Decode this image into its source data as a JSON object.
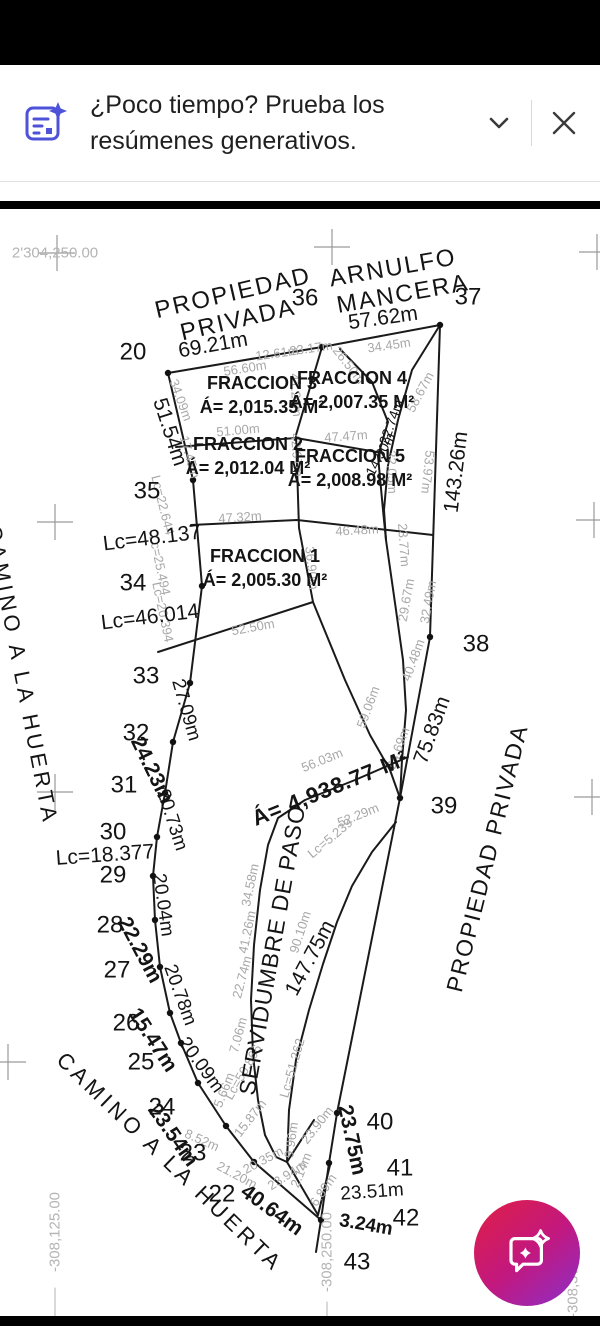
{
  "banner": {
    "title_line1": "¿Poco tiempo? Prueba los",
    "title_line2": "resúmenes generativos.",
    "accent_color": "#4e52d8"
  },
  "fab": {
    "icon": "ai-assistant-chat-icon",
    "gradient": [
      "#e01f45",
      "#c2187f",
      "#8b2fc9"
    ]
  },
  "drawing": {
    "colors": {
      "line": "#1a1a1a",
      "secondary_text": "#a8a8a8",
      "grid": "#9a9a9a"
    },
    "crosses": [
      [
        57,
        43
      ],
      [
        332,
        37
      ],
      [
        597,
        42
      ],
      [
        55,
        312
      ],
      [
        594,
        310
      ],
      [
        55,
        582
      ],
      [
        592,
        587
      ],
      [
        8,
        852
      ]
    ],
    "grid": [
      [
        "2'304,250.00",
        55,
        43,
        0
      ],
      [
        "-308,125.00",
        55,
        1022,
        -90
      ],
      [
        "-308,250.00",
        327,
        1042,
        -90
      ],
      [
        "-308,375.00",
        573,
        1068,
        -90
      ]
    ],
    "points": [
      [
        "20",
        133,
        142
      ],
      [
        "36",
        305,
        88
      ],
      [
        "37",
        468,
        87
      ],
      [
        "35",
        147,
        281
      ],
      [
        "34",
        133,
        373
      ],
      [
        "33",
        146,
        466
      ],
      [
        "32",
        136,
        523
      ],
      [
        "31",
        124,
        575
      ],
      [
        "30",
        113,
        622
      ],
      [
        "29",
        113,
        665
      ],
      [
        "28",
        110,
        715
      ],
      [
        "27",
        117,
        760
      ],
      [
        "26",
        126,
        813
      ],
      [
        "25",
        141,
        852
      ],
      [
        "24",
        162,
        897
      ],
      [
        "23",
        193,
        943
      ],
      [
        "22",
        222,
        984
      ],
      [
        "38",
        476,
        434
      ],
      [
        "39",
        444,
        596
      ],
      [
        "40",
        380,
        912
      ],
      [
        "41",
        400,
        958
      ],
      [
        "42",
        406,
        1008
      ],
      [
        "43",
        357,
        1052
      ]
    ],
    "titles": [
      [
        "PROPIEDAD",
        233,
        83,
        -13,
        24,
        0,
        2
      ],
      [
        "PRIVADA",
        238,
        110,
        -13,
        24,
        0,
        2
      ],
      [
        "ARNULFO",
        393,
        58,
        -10,
        24,
        0,
        2
      ],
      [
        "MANCERA",
        403,
        84,
        -10,
        24,
        0,
        2
      ],
      [
        "CAMINO A LA HUERTA",
        22,
        465,
        79,
        22,
        0,
        4
      ],
      [
        "CAMINO A LA HUERTA",
        170,
        952,
        44,
        22,
        0,
        4
      ],
      [
        "SERVIDUMBRE DE PASO",
        272,
        740,
        -80,
        23,
        0,
        1
      ],
      [
        "PROPIEDAD PRIVADA",
        487,
        648,
        -76,
        23,
        0,
        2
      ],
      [
        "Á= 4,938.77 M²",
        330,
        578,
        -22,
        22,
        1,
        1
      ]
    ],
    "fractions": [
      [
        "FRACCION 3",
        262,
        173,
        0,
        18,
        1
      ],
      [
        "Á= 2,015.35 M²",
        262,
        197,
        0,
        18,
        1
      ],
      [
        "FRACCION 4",
        352,
        168,
        0,
        18,
        1
      ],
      [
        "Á= 2,007.35 M²",
        352,
        192,
        0,
        18,
        1
      ],
      [
        "FRACCION 2",
        248,
        234,
        0,
        18,
        1
      ],
      [
        "Á= 2,012.04 M²",
        248,
        258,
        0,
        18,
        1
      ],
      [
        "FRACCION 5",
        350,
        246,
        0,
        18,
        1
      ],
      [
        "Á= 2,008.98 M²",
        350,
        270,
        0,
        18,
        1
      ],
      [
        "FRACCION 1",
        265,
        346,
        0,
        18,
        1
      ],
      [
        "Á= 2,005.30 M²",
        265,
        370,
        0,
        18,
        1
      ]
    ],
    "primary": [
      [
        "57.62m",
        383,
        108,
        -8,
        21
      ],
      [
        "69.21m",
        213,
        135,
        -10,
        21
      ],
      [
        "51.54m",
        170,
        222,
        72,
        21
      ],
      [
        "Lc=48.137",
        152,
        328,
        -7,
        21
      ],
      [
        "Lc=46.014",
        150,
        407,
        -7,
        21
      ],
      [
        "Lc=18.377",
        105,
        645,
        -4,
        21
      ],
      [
        "27.09m",
        186,
        500,
        74,
        19
      ],
      [
        "24.23m",
        152,
        560,
        64,
        21,
        1
      ],
      [
        "20.73m",
        172,
        610,
        72,
        19
      ],
      [
        "20.04m",
        163,
        695,
        82,
        19
      ],
      [
        "22.29m",
        140,
        740,
        62,
        21,
        1
      ],
      [
        "20.78m",
        180,
        785,
        70,
        19
      ],
      [
        "15.47m",
        153,
        830,
        57,
        21,
        1
      ],
      [
        "20.09m",
        201,
        855,
        54,
        19
      ],
      [
        "23.54m",
        173,
        925,
        55,
        21,
        1
      ],
      [
        "40.64m",
        272,
        1000,
        36,
        21,
        1
      ],
      [
        "23.75m",
        352,
        930,
        78,
        21,
        1
      ],
      [
        "23.51m",
        372,
        982,
        -4,
        19
      ],
      [
        "3.24m",
        366,
        1015,
        10,
        19,
        1
      ],
      [
        "143.26m",
        456,
        262,
        -83,
        21
      ],
      [
        "75.83m",
        432,
        520,
        -70,
        21
      ],
      [
        "147.75m",
        310,
        748,
        -62,
        21
      ],
      [
        "22.74m",
        391,
        212,
        -70,
        14
      ],
      [
        "14.50m",
        380,
        244,
        -62,
        14
      ]
    ],
    "secondary": [
      [
        "56.60m",
        245,
        158,
        -9
      ],
      [
        "12.61m",
        277,
        143,
        -8
      ],
      [
        "23.17m",
        311,
        138,
        -8
      ],
      [
        "26.50m",
        349,
        155,
        52
      ],
      [
        "34.45m",
        389,
        135,
        -8
      ],
      [
        "41.21m",
        296,
        185,
        86
      ],
      [
        "58.67m",
        420,
        182,
        -62
      ],
      [
        "51.00m",
        238,
        220,
        -5
      ],
      [
        "47.47m",
        346,
        226,
        -4
      ],
      [
        "34.09m",
        181,
        190,
        70
      ],
      [
        "17.45m",
        190,
        247,
        74
      ],
      [
        "32.05m",
        392,
        262,
        88
      ],
      [
        "53.97m",
        428,
        262,
        96
      ],
      [
        "42.97m",
        297,
        245,
        86
      ],
      [
        "Lc=22.644",
        163,
        295,
        76
      ],
      [
        "47.32m",
        240,
        307,
        -4
      ],
      [
        "46.48m",
        357,
        320,
        -3
      ],
      [
        "23.77m",
        404,
        335,
        86
      ],
      [
        "Lc=25.494",
        160,
        355,
        78
      ],
      [
        "36.90m",
        312,
        358,
        84
      ],
      [
        "Lc=20.394",
        163,
        402,
        78
      ],
      [
        "29.67m",
        406,
        390,
        -80
      ],
      [
        "32.49m",
        428,
        392,
        -80
      ],
      [
        "52.50m",
        253,
        417,
        -10
      ],
      [
        "40.48m",
        413,
        450,
        -70
      ],
      [
        "59.06m",
        368,
        497,
        -70
      ],
      [
        "24.69m",
        398,
        538,
        -70
      ],
      [
        "56.03m",
        322,
        550,
        -22
      ],
      [
        "52.29m",
        358,
        605,
        -22
      ],
      [
        "Lc=5.239",
        330,
        628,
        -40
      ],
      [
        "34.58m",
        250,
        675,
        -78
      ],
      [
        "90.10m",
        300,
        722,
        -72
      ],
      [
        "41.26m",
        247,
        722,
        -78
      ],
      [
        "22.74m",
        242,
        767,
        -75
      ],
      [
        "7.06m",
        238,
        825,
        -75
      ],
      [
        "5.66m",
        224,
        880,
        -68
      ],
      [
        "Lc=50.866",
        243,
        862,
        -60
      ],
      [
        "15.87m",
        250,
        908,
        -52
      ],
      [
        "Lc=51.262",
        292,
        858,
        -74
      ],
      [
        "23.90m",
        317,
        915,
        -52
      ],
      [
        "9.96m",
        291,
        930,
        -82
      ],
      [
        "20.35m",
        263,
        950,
        -28
      ],
      [
        "23.94m",
        287,
        965,
        -33
      ],
      [
        "2.14m",
        301,
        960,
        -68
      ],
      [
        "6.89m",
        323,
        980,
        -55
      ],
      [
        "8.52m",
        202,
        930,
        24
      ],
      [
        "21.20m",
        237,
        965,
        28
      ]
    ],
    "lines": [
      {
        "n": "boundary-west",
        "p": [
          [
            168,
            163
          ],
          [
            193,
            270
          ],
          [
            202,
            376
          ],
          [
            190,
            473
          ],
          [
            173,
            532
          ],
          [
            165,
            583
          ],
          [
            157,
            627
          ],
          [
            153,
            666
          ],
          [
            155,
            710
          ],
          [
            160,
            757
          ],
          [
            170,
            803
          ],
          [
            181,
            833
          ],
          [
            198,
            873
          ],
          [
            226,
            916
          ],
          [
            254,
            952
          ]
        ]
      },
      {
        "n": "boundary-top",
        "p": [
          [
            168,
            163
          ],
          [
            322,
            137
          ],
          [
            440,
            115
          ]
        ]
      },
      {
        "n": "boundary-east",
        "p": [
          [
            440,
            115
          ],
          [
            430,
            427
          ],
          [
            400,
            588
          ],
          [
            337,
            903
          ],
          [
            329,
            953
          ],
          [
            321,
            1010
          ],
          [
            316,
            1042
          ]
        ]
      },
      {
        "n": "boundary-bottom",
        "p": [
          [
            254,
            952
          ],
          [
            321,
            1010
          ]
        ]
      },
      {
        "n": "divider-center",
        "p": [
          [
            322,
            137
          ],
          [
            296,
            225
          ],
          [
            299,
            318
          ],
          [
            313,
            392
          ]
        ]
      },
      {
        "n": "divider-f3-f2",
        "p": [
          [
            176,
            237
          ],
          [
            296,
            228
          ],
          [
            383,
            243
          ]
        ]
      },
      {
        "n": "divider-f2-f1",
        "p": [
          [
            191,
            315
          ],
          [
            297,
            310
          ],
          [
            433,
            325
          ]
        ]
      },
      {
        "n": "f1-south",
        "p": [
          [
            158,
            442
          ],
          [
            313,
            392
          ]
        ]
      },
      {
        "n": "east-zigzag",
        "p": [
          [
            340,
            139
          ],
          [
            372,
            172
          ],
          [
            388,
            212
          ],
          [
            378,
            246
          ],
          [
            383,
            300
          ],
          [
            386,
            330
          ],
          [
            396,
            400
          ],
          [
            403,
            450
          ],
          [
            406,
            500
          ],
          [
            402,
            550
          ],
          [
            400,
            588
          ]
        ]
      },
      {
        "n": "east-sliver",
        "p": [
          [
            440,
            115
          ],
          [
            412,
            160
          ],
          [
            398,
            210
          ],
          [
            388,
            255
          ],
          [
            384,
            300
          ],
          [
            386,
            330
          ]
        ]
      },
      {
        "n": "south-f1-line",
        "p": [
          [
            313,
            392
          ],
          [
            345,
            470
          ],
          [
            370,
            525
          ],
          [
            390,
            560
          ],
          [
            400,
            588
          ]
        ]
      },
      {
        "n": "easement-west",
        "p": [
          [
            408,
            547
          ],
          [
            355,
            570
          ],
          [
            305,
            590
          ],
          [
            278,
            608
          ],
          [
            268,
            635
          ],
          [
            260,
            680
          ],
          [
            254,
            735
          ],
          [
            251,
            790
          ],
          [
            253,
            845
          ],
          [
            258,
            890
          ],
          [
            265,
            925
          ],
          [
            276,
            947
          ],
          [
            287,
            952
          ]
        ]
      },
      {
        "n": "easement-east",
        "p": [
          [
            396,
            612
          ],
          [
            372,
            642
          ],
          [
            352,
            676
          ],
          [
            337,
            712
          ],
          [
            323,
            754
          ],
          [
            309,
            800
          ],
          [
            296,
            850
          ],
          [
            289,
            900
          ],
          [
            287,
            952
          ]
        ]
      },
      {
        "n": "tip-a",
        "p": [
          [
            287,
            952
          ],
          [
            314,
            910
          ]
        ]
      },
      {
        "n": "tip-b",
        "p": [
          [
            287,
            952
          ],
          [
            318,
            1005
          ]
        ]
      },
      {
        "n": "tip-c",
        "p": [
          [
            318,
            1005
          ],
          [
            330,
            955
          ]
        ]
      },
      {
        "n": "grid-tick-1",
        "p": [
          [
            55,
            1078
          ],
          [
            55,
            1108
          ]
        ],
        "g": 1
      },
      {
        "n": "grid-tick-2",
        "p": [
          [
            327,
            1092
          ],
          [
            327,
            1114
          ]
        ],
        "g": 1
      }
    ],
    "dots": [
      [
        168,
        163
      ],
      [
        322,
        137
      ],
      [
        440,
        115
      ],
      [
        193,
        270
      ],
      [
        202,
        376
      ],
      [
        190,
        473
      ],
      [
        173,
        532
      ],
      [
        165,
        583
      ],
      [
        157,
        627
      ],
      [
        153,
        666
      ],
      [
        155,
        710
      ],
      [
        160,
        757
      ],
      [
        170,
        803
      ],
      [
        181,
        833
      ],
      [
        198,
        873
      ],
      [
        226,
        916
      ],
      [
        254,
        952
      ],
      [
        430,
        427
      ],
      [
        400,
        588
      ],
      [
        337,
        903
      ],
      [
        329,
        953
      ],
      [
        321,
        1010
      ]
    ]
  }
}
